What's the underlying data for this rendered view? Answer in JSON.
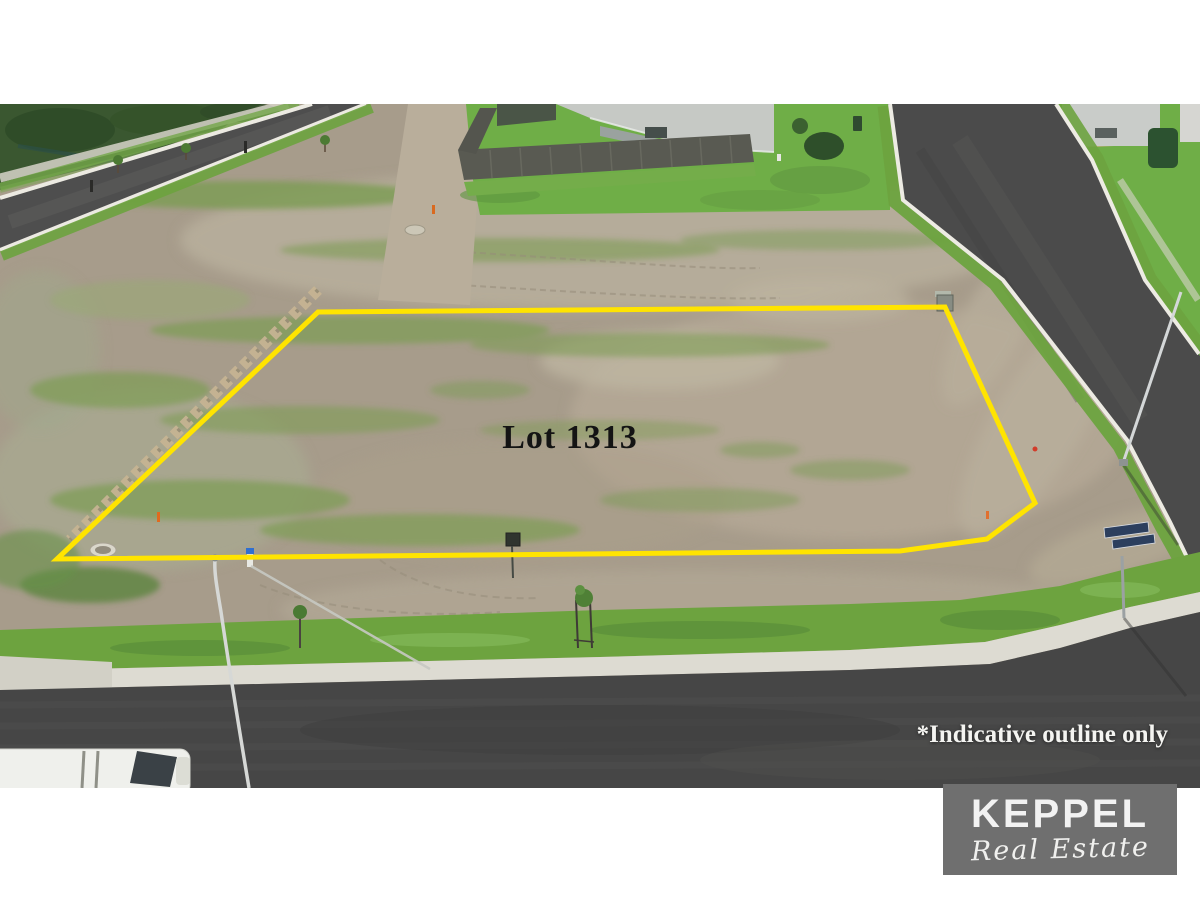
{
  "overlay": {
    "lot_label": "Lot 1313",
    "disclaimer": "*Indicative outline only"
  },
  "logo": {
    "brand": "KEPPEL",
    "tagline": "Real Estate",
    "background": "#6f6f6f",
    "text_color": "#f2f2f2"
  },
  "colors": {
    "page_background": "#ffffff",
    "lot_outline": "#ffe400",
    "dirt": "#a79c8b",
    "grass_verge": "#6da33f",
    "asphalt": "#464646",
    "kerb_concrete": "#dddbd2"
  }
}
